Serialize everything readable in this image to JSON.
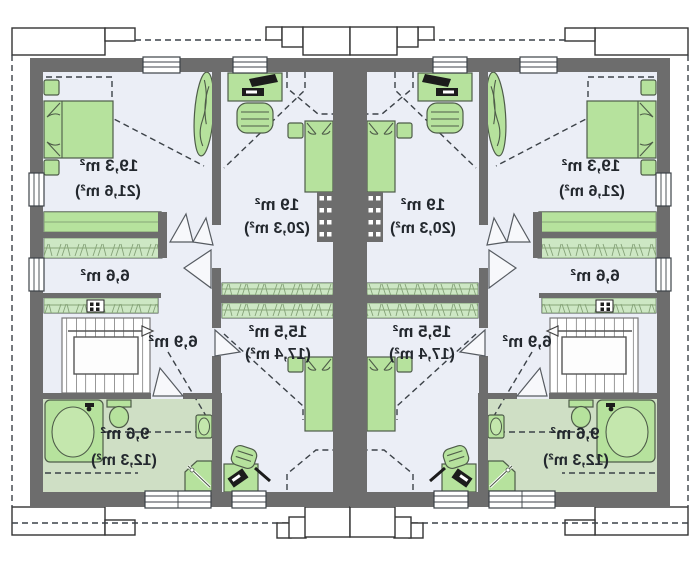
{
  "plan_type": "duplex-attic-floor-plan-mirrored",
  "units": [
    {
      "side": "left",
      "rooms": [
        {
          "id": "bedroom-top",
          "area": "19,3 m²",
          "floor_area": "(21,6 m²)"
        },
        {
          "id": "bedroom-middle",
          "area": "19 m²",
          "floor_area": "(20,3 m²)"
        },
        {
          "id": "wardrobe-hall",
          "area": "6,6 m²"
        },
        {
          "id": "stair-hall",
          "area": "6,9 m²"
        },
        {
          "id": "bedroom-bottom",
          "area": "15,5 m²",
          "floor_area": "(17,4 m²)"
        },
        {
          "id": "bathroom",
          "area": "9,6 m²",
          "floor_area": "(12,3 m²)"
        }
      ]
    },
    {
      "side": "right",
      "rooms": [
        {
          "id": "bedroom-top",
          "area": "19,3 m²",
          "floor_area": "(21,6 m²)"
        },
        {
          "id": "bedroom-middle",
          "area": "19 m²",
          "floor_area": "(20,3 m²)"
        },
        {
          "id": "wardrobe-hall",
          "area": "6,6 m²"
        },
        {
          "id": "stair-hall",
          "area": "6,9 m²"
        },
        {
          "id": "bedroom-bottom",
          "area": "15,5 m²",
          "floor_area": "(17,4 m²)"
        },
        {
          "id": "bathroom",
          "area": "9,6 m²",
          "floor_area": "(12,3 m²)"
        }
      ]
    }
  ],
  "symbols": [
    "double-bed",
    "single-bed",
    "nightstand",
    "wardrobe",
    "desk",
    "computer",
    "chair",
    "plant",
    "stairs",
    "direction-arrow",
    "washer",
    "bathtub",
    "toilet",
    "sink",
    "shower",
    "chimney-vent",
    "window",
    "open-door",
    "roof-slope-dashed-line",
    "eave-hatch"
  ],
  "colors": {
    "wall": "#6d6d6d",
    "floor": "#ebeef6",
    "bathroom_floor": "#cfdfc5",
    "furniture": "#b6e29d",
    "furniture_stroke": "#4e5c49",
    "outline": "#3c4248",
    "text": "#23282e"
  }
}
